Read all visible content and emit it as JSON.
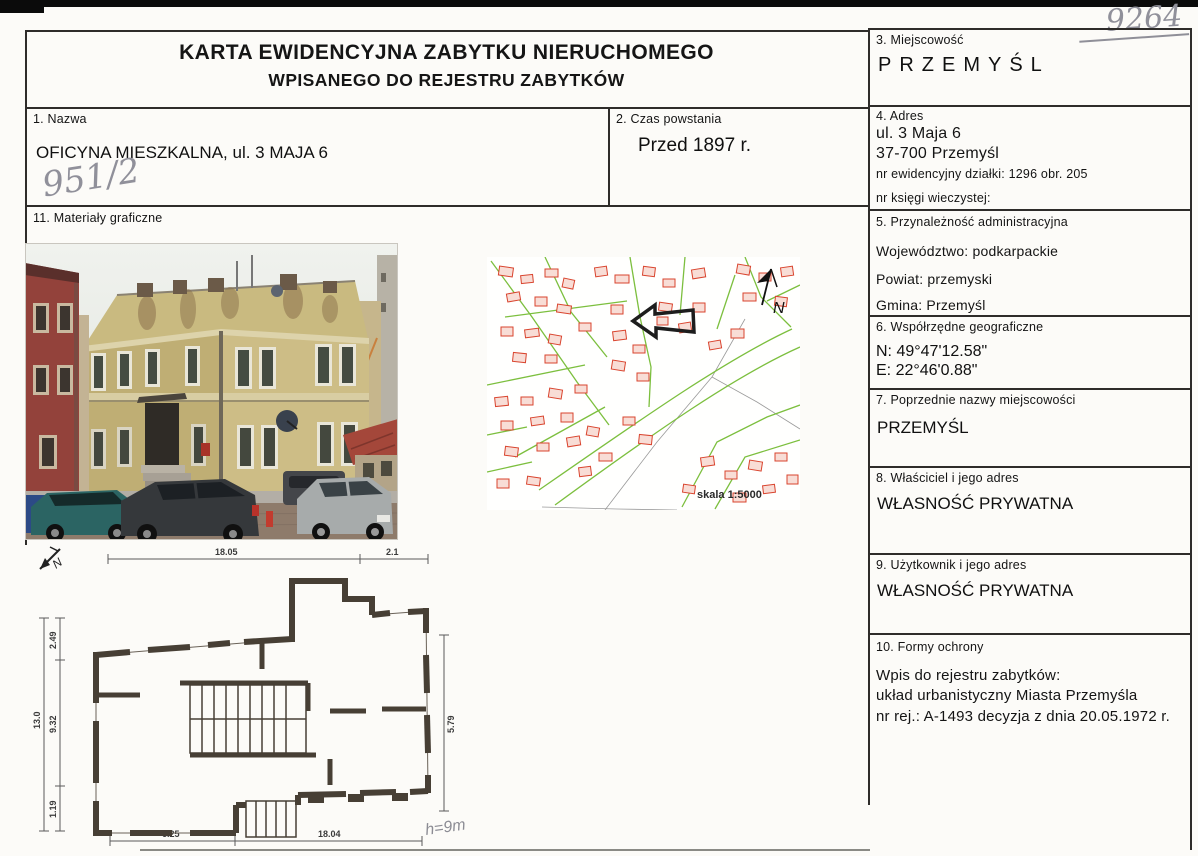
{
  "scan": {
    "number": "9264"
  },
  "header": {
    "title_line1": "KARTA EWIDENCYJNA ZABYTKU NIERUCHOMEGO",
    "title_line2": "WPISANEGO DO REJESTRU ZABYTKÓW"
  },
  "sections": {
    "s1": {
      "label": "1. Nazwa",
      "value": "OFICYNA MIESZKALNA, ul. 3 MAJA 6",
      "handwritten": "951/2"
    },
    "s2": {
      "label": "2. Czas powstania",
      "value": "Przed 1897 r."
    },
    "s3": {
      "label": "3. Miejscowość",
      "value": "PRZEMYŚL"
    },
    "s4": {
      "label": "4. Adres",
      "line1": "ul. 3 Maja 6",
      "line2": "37-700 Przemyśl",
      "line3": "nr ewidencyjny działki: 1296 obr. 205",
      "line4": "nr księgi wieczystej:"
    },
    "s5": {
      "label": "5. Przynależność administracyjna",
      "voivodeship": "Województwo: podkarpackie",
      "county": "Powiat: przemyski",
      "commune": "Gmina: Przemyśl"
    },
    "s6": {
      "label": "6. Współrzędne geograficzne",
      "north": "N: 49°47'12.58\"",
      "east": "E: 22°46'0.88\""
    },
    "s7": {
      "label": "7. Poprzednie nazwy miejscowości",
      "value": "PRZEMYŚL"
    },
    "s8": {
      "label": "8. Właściciel i jego adres",
      "value": "WŁASNOŚĆ PRYWATNA"
    },
    "s9": {
      "label": "9. Użytkownik i jego adres",
      "value": "WŁASNOŚĆ PRYWATNA"
    },
    "s10": {
      "label": "10. Formy ochrony",
      "line1": "Wpis do rejestru zabytków:",
      "line2": "układ urbanistyczny Miasta Przemyśla",
      "line3": "nr rej.: A-1493 decyzja z dnia 20.05.1972 r."
    },
    "s11": {
      "label": "11. Materiały graficzne"
    }
  },
  "map": {
    "scale_label": "skala 1:5000",
    "north_label": "N"
  },
  "plan": {
    "north_label": "N",
    "handwritten_height": "h=9m",
    "dims": {
      "top_left": "18.05",
      "top_right": "2.1",
      "left_total": "13.0",
      "left_top": "2.49",
      "left_mid": "9.32",
      "left_bottom": "1.19",
      "right": "5.79",
      "bottom_left": "6.25",
      "bottom_right": "18.04"
    }
  },
  "colors": {
    "border": "#2e2c2a",
    "pencil": "#90909a",
    "map_street_green": "#7cbf3e",
    "map_building_red": "#d9442e",
    "facade_tan": "#cdbd86",
    "facade_red": "#93423b"
  }
}
